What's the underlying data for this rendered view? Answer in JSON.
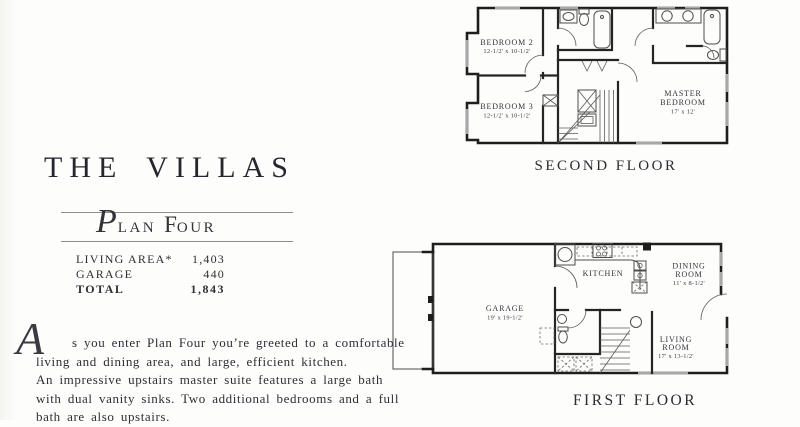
{
  "brochure": {
    "title": "THE VILLAS",
    "plan_name": {
      "script_initial": "P",
      "word1_rest": "LAN",
      "word2_initial": "F",
      "word2_rest": "OUR"
    },
    "stats": {
      "living_area_label": "LIVING AREA*",
      "living_area_value": "1,403",
      "garage_label": "GARAGE",
      "garage_value": "440",
      "total_label": "TOTAL",
      "total_value": "1,843"
    },
    "description": {
      "drop_cap": "A",
      "lines": [
        "s you enter Plan Four you’re greeted to a comfortable",
        "living and dining area, and large, efficient kitchen.",
        "An impressive upstairs master suite features a large bath",
        "with dual vanity sinks. Two additional bedrooms and a full",
        "bath are also upstairs."
      ]
    }
  },
  "second_floor": {
    "caption": "SECOND FLOOR",
    "bedroom2_name": "BEDROOM 2",
    "bedroom2_dims": "12-1/2' x 10-1/2'",
    "bedroom3_name": "BEDROOM 3",
    "bedroom3_dims": "12-1/2' x 10-1/2'",
    "master_name1": "MASTER",
    "master_name2": "BEDROOM",
    "master_dims": "17' x 12'"
  },
  "first_floor": {
    "caption": "FIRST FLOOR",
    "garage_name": "GARAGE",
    "garage_dims": "19' x 19-1/2'",
    "kitchen_name": "KITCHEN",
    "dining_name1": "DINING",
    "dining_name2": "ROOM",
    "dining_dims": "11' x 8-1/2'",
    "living_name1": "LIVING",
    "living_name2": "ROOM",
    "living_dims": "17' x 13-1/2'"
  },
  "colors": {
    "ink": "#2f2f38",
    "wall": "#1e1e1e",
    "thin_line": "#4d4d4d",
    "window": "#a8a8a8",
    "rule": "#8f8f8f",
    "background": "#fdfdfb"
  }
}
